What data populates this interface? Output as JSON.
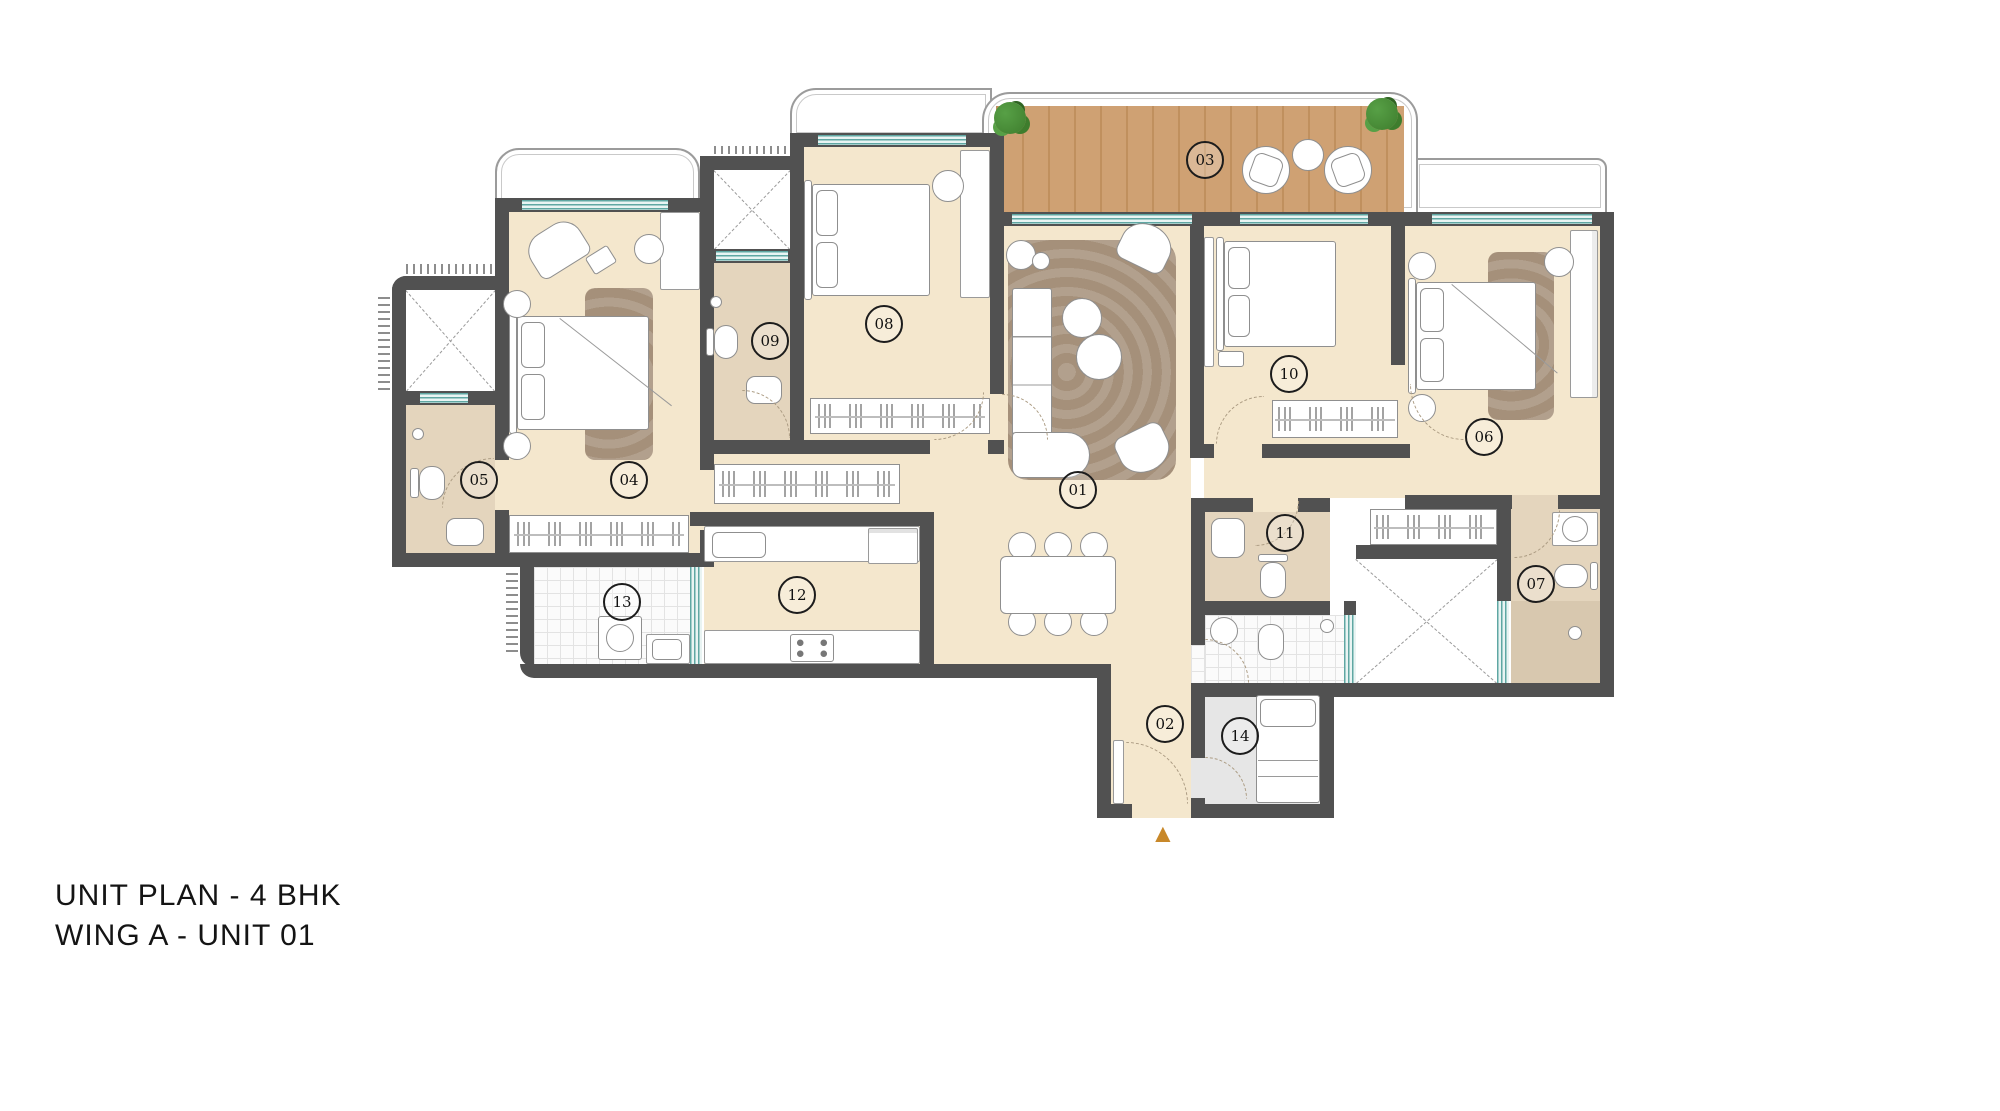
{
  "title": {
    "line1": "UNIT PLAN - 4 BHK",
    "line2": "WING A - UNIT 01"
  },
  "rooms": [
    {
      "label": "01"
    },
    {
      "label": "02"
    },
    {
      "label": "03"
    },
    {
      "label": "04"
    },
    {
      "label": "05"
    },
    {
      "label": "06"
    },
    {
      "label": "07"
    },
    {
      "label": "08"
    },
    {
      "label": "09"
    },
    {
      "label": "10"
    },
    {
      "label": "11"
    },
    {
      "label": "12"
    },
    {
      "label": "13"
    },
    {
      "label": "14"
    }
  ],
  "entrance": {
    "marker": "▲"
  },
  "colors": {
    "wall": "#515151",
    "floor": "#f4e7cd",
    "bath_floor": "#e4d5bd",
    "wood": "#cfa173",
    "wood_dark": "#c0905e",
    "rug": "#a5907a",
    "glass": "#5fa7a3",
    "gray_room": "#e6e6e6",
    "tile_bg": "#fbfbfb",
    "accent": "#c8882a",
    "plant": "#3e7d2d",
    "line": "#8f8f8f"
  }
}
